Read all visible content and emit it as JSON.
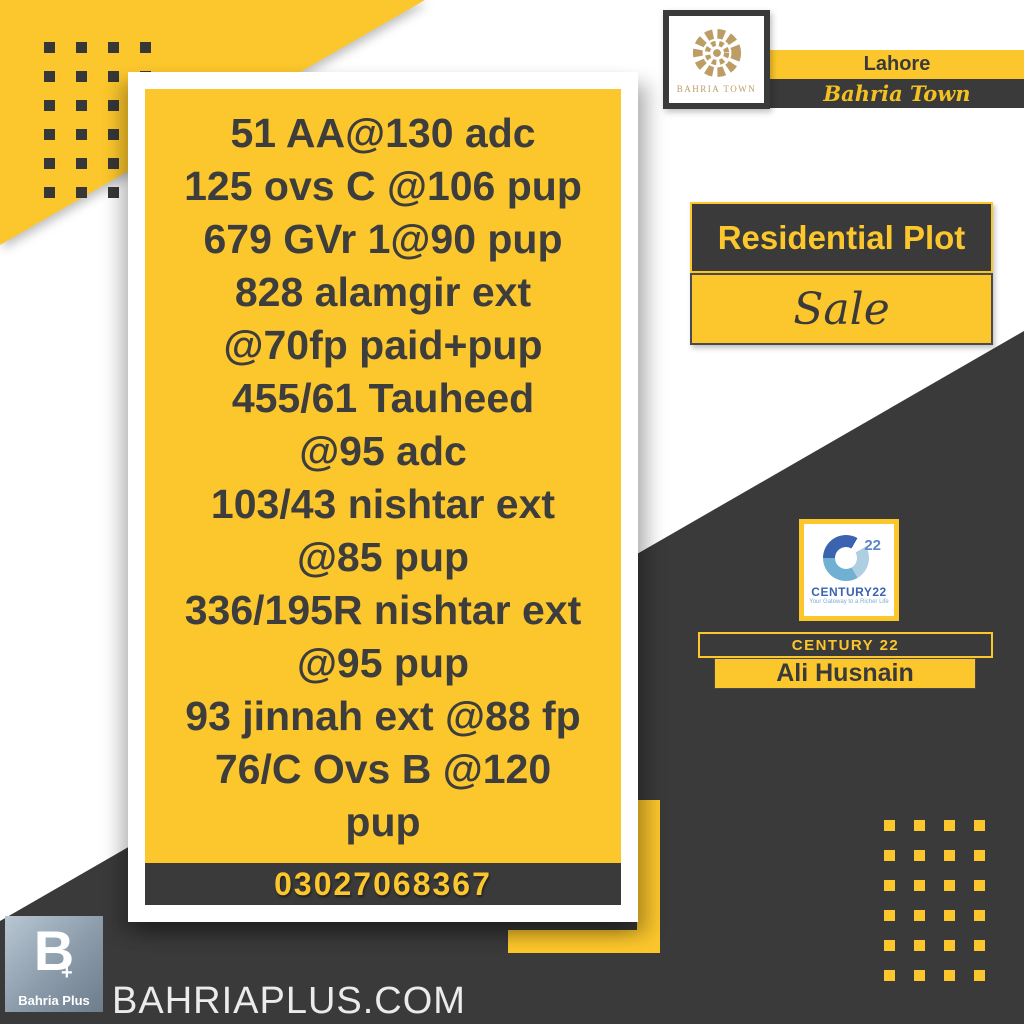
{
  "colors": {
    "accent_yellow": "#FCC72C",
    "charcoal": "#3A3A3A",
    "listing_text": "#3D3D3D",
    "gold_emblem": "#BD9D66",
    "century_blue": "#3B63B0",
    "century_light_blue": "#7AB0D3"
  },
  "listing": {
    "lines": [
      "51 AA@130 adc",
      "125 ovs C @106 pup",
      "679 GVr 1@90 pup",
      "828 alamgir ext",
      "@70fp paid+pup",
      "455/61 Tauheed",
      "@95 adc",
      "103/43 nishtar ext",
      "@85 pup",
      "336/195R nishtar ext",
      "@95 pup",
      "93 jinnah ext @88 fp",
      "76/C Ovs B @120",
      "pup"
    ],
    "phone": "03027068367"
  },
  "developer": {
    "logo_name": "BAHRIA TOWN",
    "city": "Lahore",
    "brand": "Bahria Town"
  },
  "offer": {
    "category": "Residential Plot",
    "type": "Sale"
  },
  "agent": {
    "company": "CENTURY 22",
    "name": "Ali Husnain",
    "logo_number": "22",
    "logo_text": "CENTURY22",
    "logo_tagline": "Your Gateway to a Richer Life"
  },
  "footer": {
    "website": "BAHRIAPLUS.COM",
    "logo_label": "Bahria Plus",
    "logo_monogram": "B",
    "logo_plus": "+"
  }
}
